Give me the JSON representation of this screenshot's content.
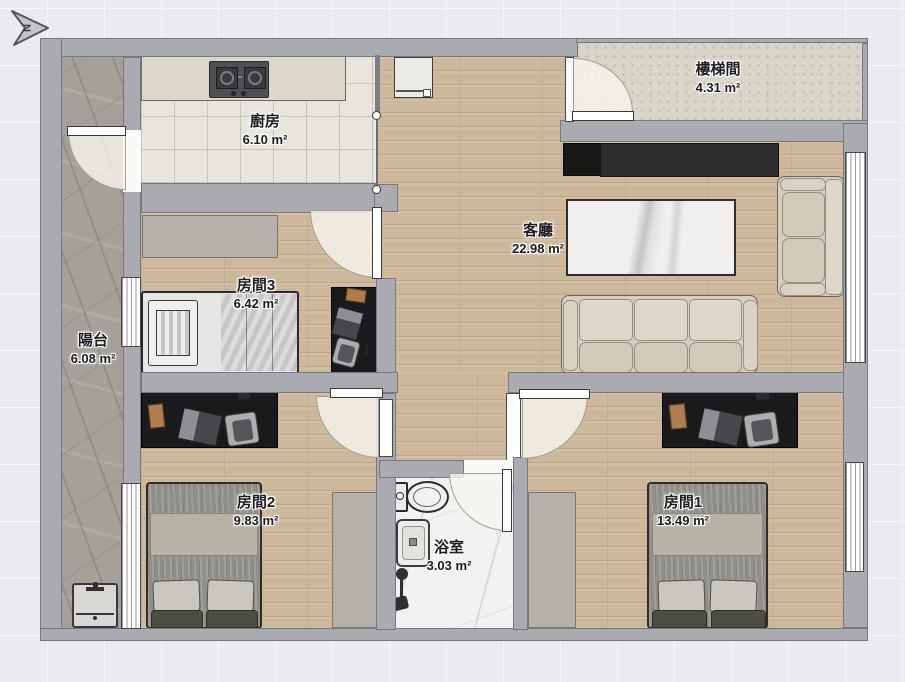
{
  "plan": {
    "compass_label": "N",
    "rooms": [
      {
        "id": "stairwell",
        "name": "樓梯間",
        "area": "4.31 m²"
      },
      {
        "id": "kitchen",
        "name": "廚房",
        "area": "6.10 m²"
      },
      {
        "id": "living",
        "name": "客廳",
        "area": "22.98 m²"
      },
      {
        "id": "room3",
        "name": "房間3",
        "area": "6.42 m²"
      },
      {
        "id": "balcony",
        "name": "陽台",
        "area": "6.08 m²"
      },
      {
        "id": "room2",
        "name": "房間2",
        "area": "9.83 m²"
      },
      {
        "id": "bathroom",
        "name": "浴室",
        "area": "3.03 m²"
      },
      {
        "id": "room1",
        "name": "房間1",
        "area": "13.49 m²"
      }
    ],
    "colors": {
      "wall": "#a9abb0",
      "wood_floor": "#cdb89b",
      "kitchen_tile": "#e8e5dd",
      "balcony_stone": "#a5a19a",
      "stairwell_concrete": "#d9d5c8",
      "bathroom_marble": "#f3f2f0",
      "desk_black": "#1a1a1c",
      "background": "#e9ebf1"
    }
  }
}
